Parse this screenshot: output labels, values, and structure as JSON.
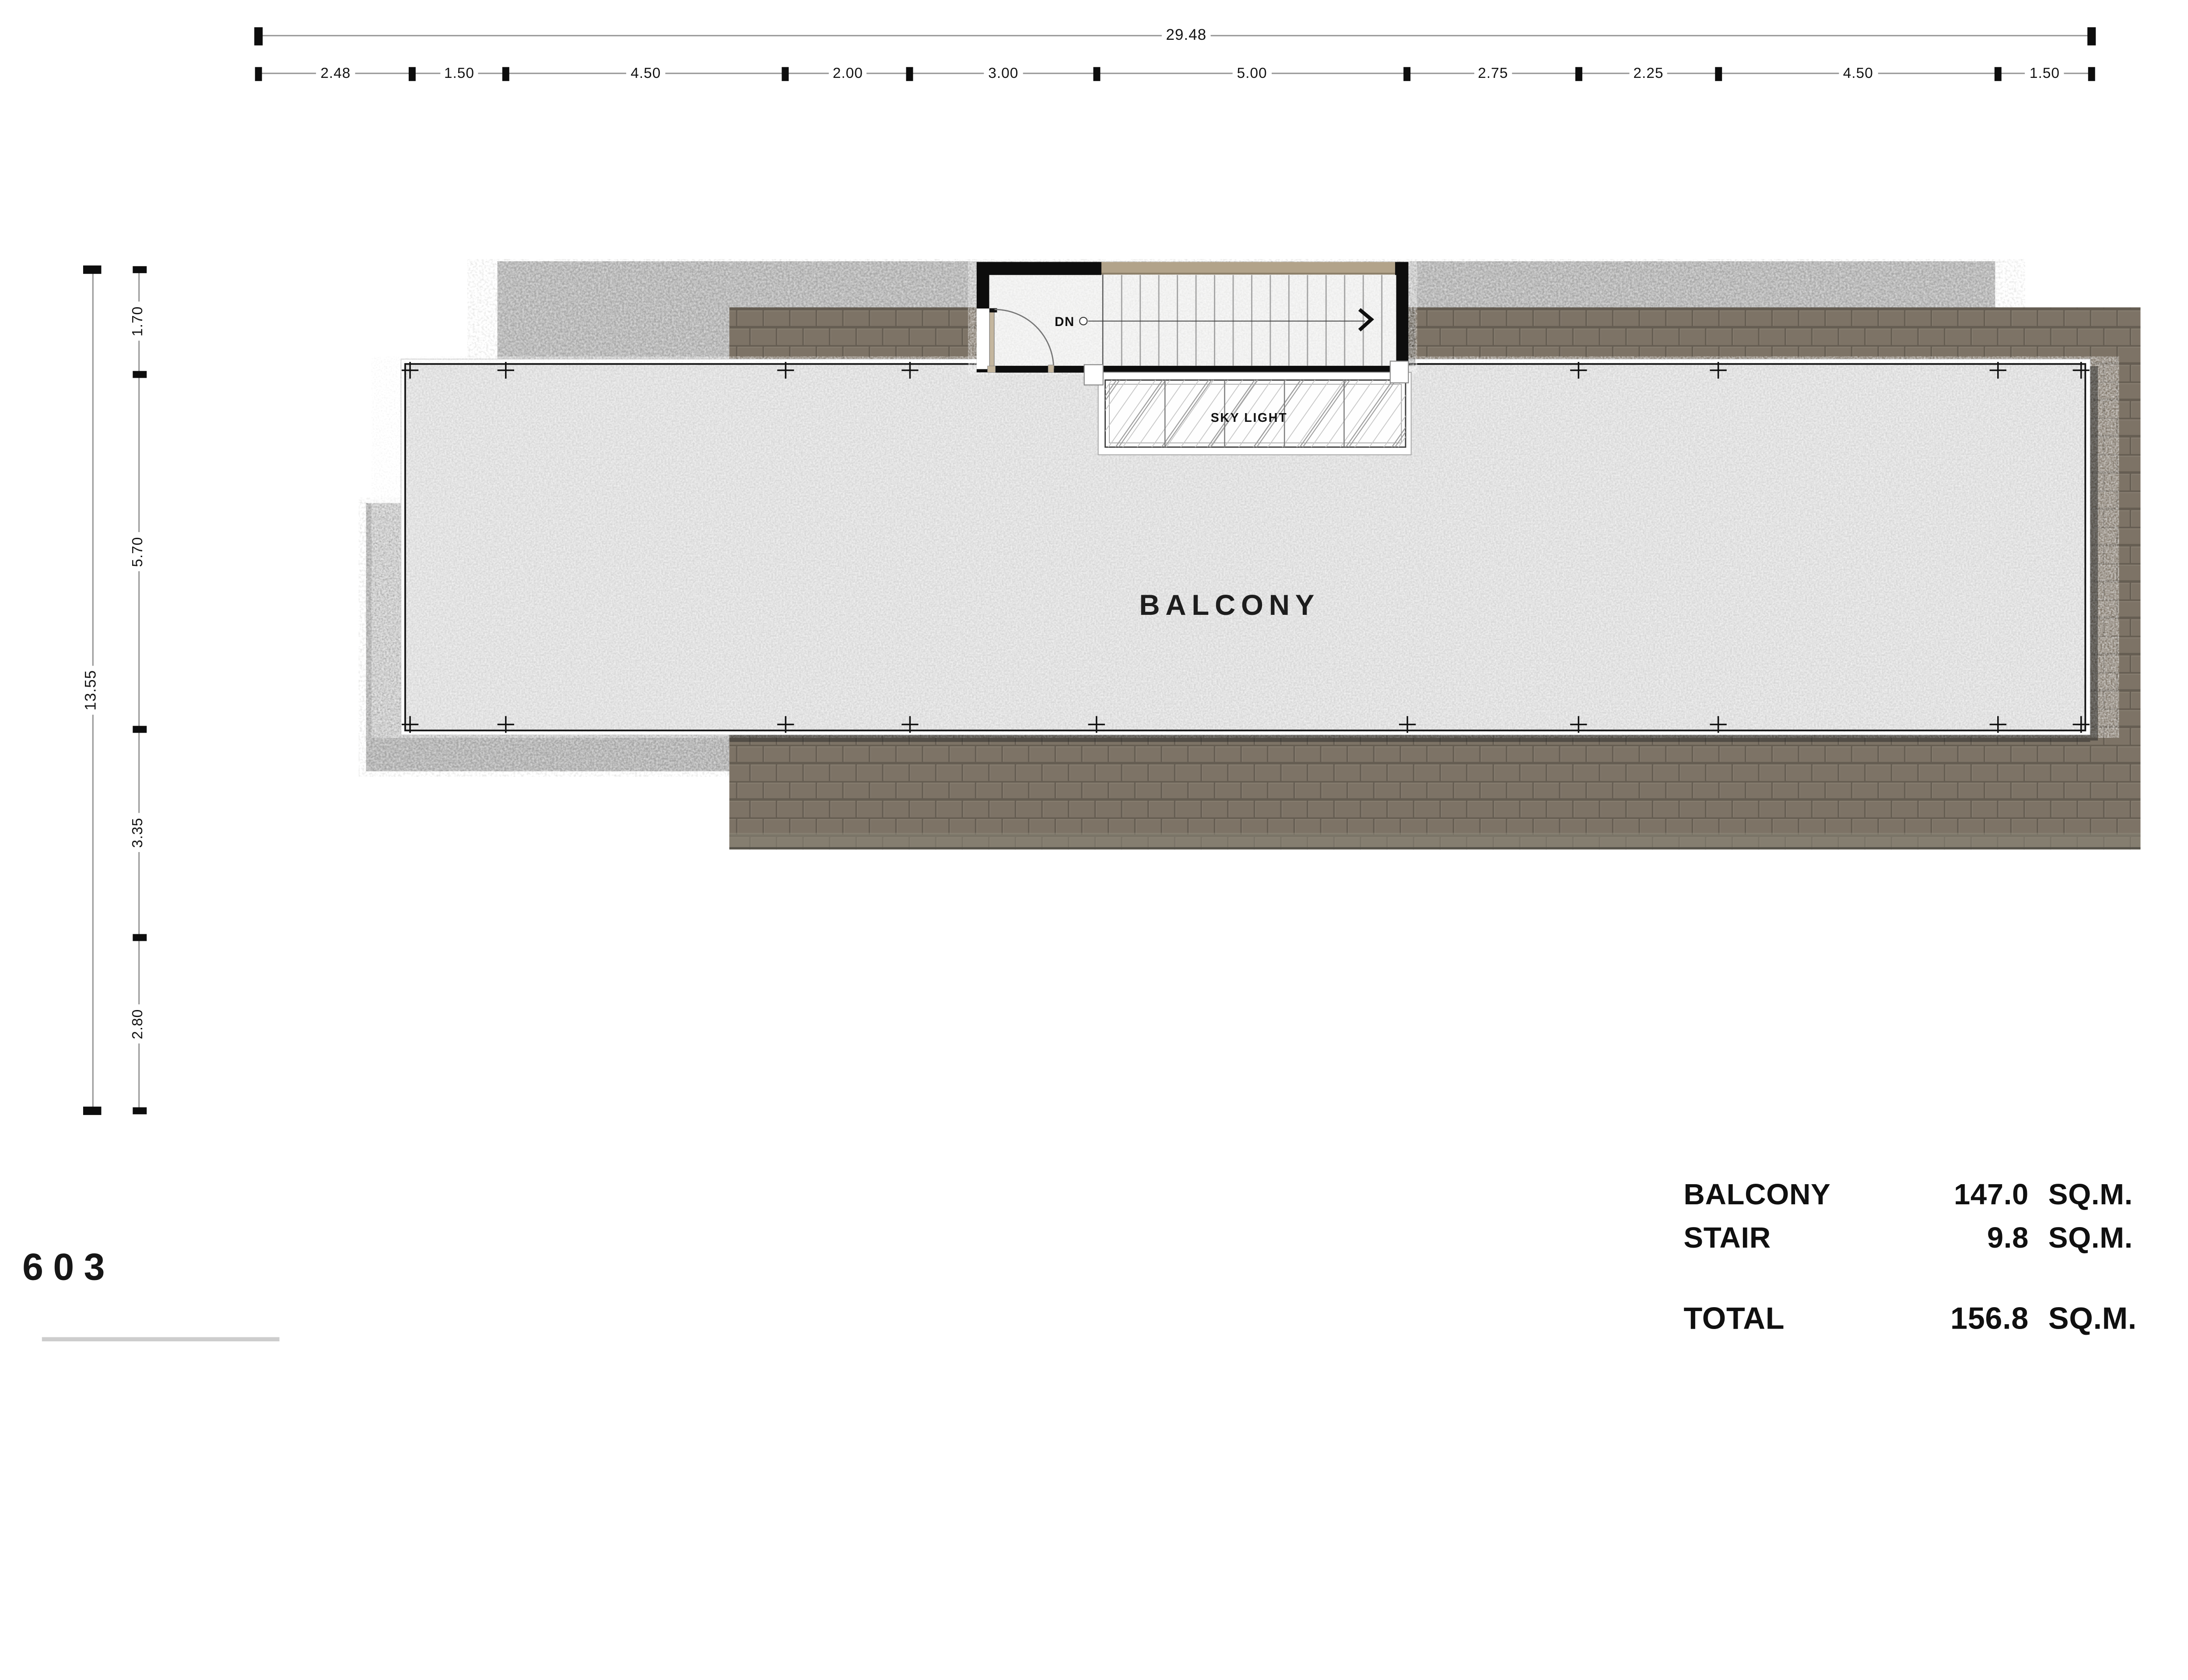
{
  "sheet": {
    "drawing_number": "603"
  },
  "dimensions": {
    "top": {
      "total": "29.48",
      "segments": [
        "2.48",
        "1.50",
        "4.50",
        "2.00",
        "3.00",
        "5.00",
        "2.75",
        "2.25",
        "4.50",
        "1.50"
      ]
    },
    "left": {
      "total": "13.55",
      "segments": [
        "1.70",
        "5.70",
        "3.35",
        "2.80"
      ]
    }
  },
  "plan": {
    "balcony_label": "BALCONY",
    "stair": {
      "dn_label": "DN"
    },
    "skylight_label": "SKY LIGHT"
  },
  "area_table": {
    "rows": [
      {
        "name": "BALCONY",
        "value": "147.0",
        "unit": "SQ.M."
      },
      {
        "name": "STAIR",
        "value": "9.8",
        "unit": "SQ.M."
      }
    ],
    "total": {
      "name": "TOTAL",
      "value": "156.8",
      "unit": "SQ.M."
    }
  },
  "colors": {
    "ink": "#111111",
    "brick": "#7d7366",
    "mortar": "#655d52",
    "roof_gray": "#a8a8a8",
    "side_gray": "#a4a4a4",
    "slab_gray": "#d6d6d6",
    "stair_floor": "#ededec",
    "tan_band": "#b2a38a",
    "door_leaf": "#c4b69e"
  }
}
